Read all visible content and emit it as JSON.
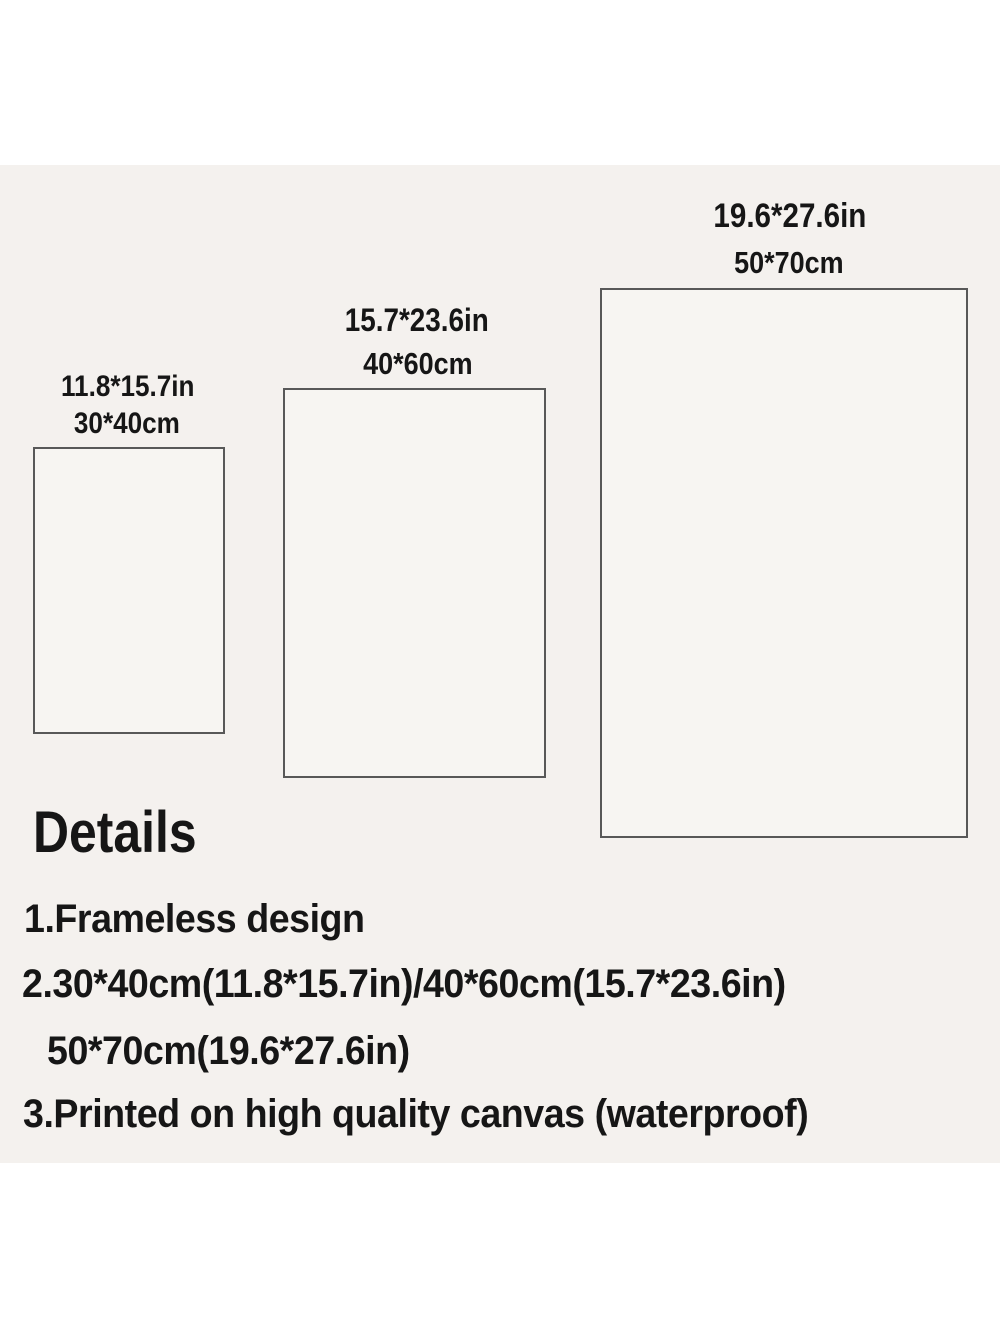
{
  "sizes": [
    {
      "inches": "11.8*15.7in",
      "cm": "30*40cm"
    },
    {
      "inches": "15.7*23.6in",
      "cm": "40*60cm"
    },
    {
      "inches": "19.6*27.6in",
      "cm": "50*70cm"
    }
  ],
  "details": {
    "heading": "Details",
    "lines": [
      "1.Frameless design",
      "2.30*40cm(11.8*15.7in)/40*60cm(15.7*23.6in)",
      "50*70cm(19.6*27.6in)",
      "3.Printed on high quality canvas (waterproof)"
    ]
  },
  "colors": {
    "page": "#ffffff",
    "band": "#f4f1ee",
    "box_fill": "#f7f5f2",
    "box_border": "#585858",
    "text": "#161616"
  }
}
